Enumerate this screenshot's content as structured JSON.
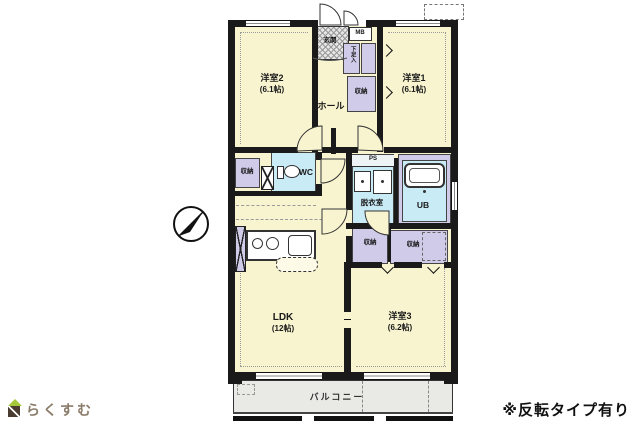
{
  "meta": {
    "note": "※反転タイプ有り",
    "logo_text": "らくすむ"
  },
  "rooms": {
    "western1": {
      "name": "洋室1",
      "size": "(6.1帖)"
    },
    "western2": {
      "name": "洋室2",
      "size": "(6.1帖)"
    },
    "western3": {
      "name": "洋室3",
      "size": "(6.2帖)"
    },
    "ldk": {
      "name": "LDK",
      "size": "(12帖)"
    },
    "hall": {
      "name": "ホール"
    },
    "balcony": {
      "name": "バルコニー"
    },
    "entrance": {
      "name": "玄関"
    },
    "toilet": {
      "name": "WC"
    },
    "dressing": {
      "name": "脱衣室"
    },
    "unit_bath": {
      "name": "UB"
    },
    "shoe_box": {
      "name": "下足入"
    },
    "storage": {
      "name": "収納"
    },
    "meter_box": {
      "name": "MB"
    },
    "pipe_space": {
      "name": "PS"
    }
  },
  "colors": {
    "wall": "#1a1a1a",
    "room_fill": "#f8f4d0",
    "storage_fill": "#cfcbe8",
    "wet_fill": "#c9ebf5",
    "balcony_fill": "#e9e9e6",
    "logo_green": "#a5c73a",
    "logo_brown": "#4a3c30",
    "logo_text_color": "#8b7c6a"
  }
}
